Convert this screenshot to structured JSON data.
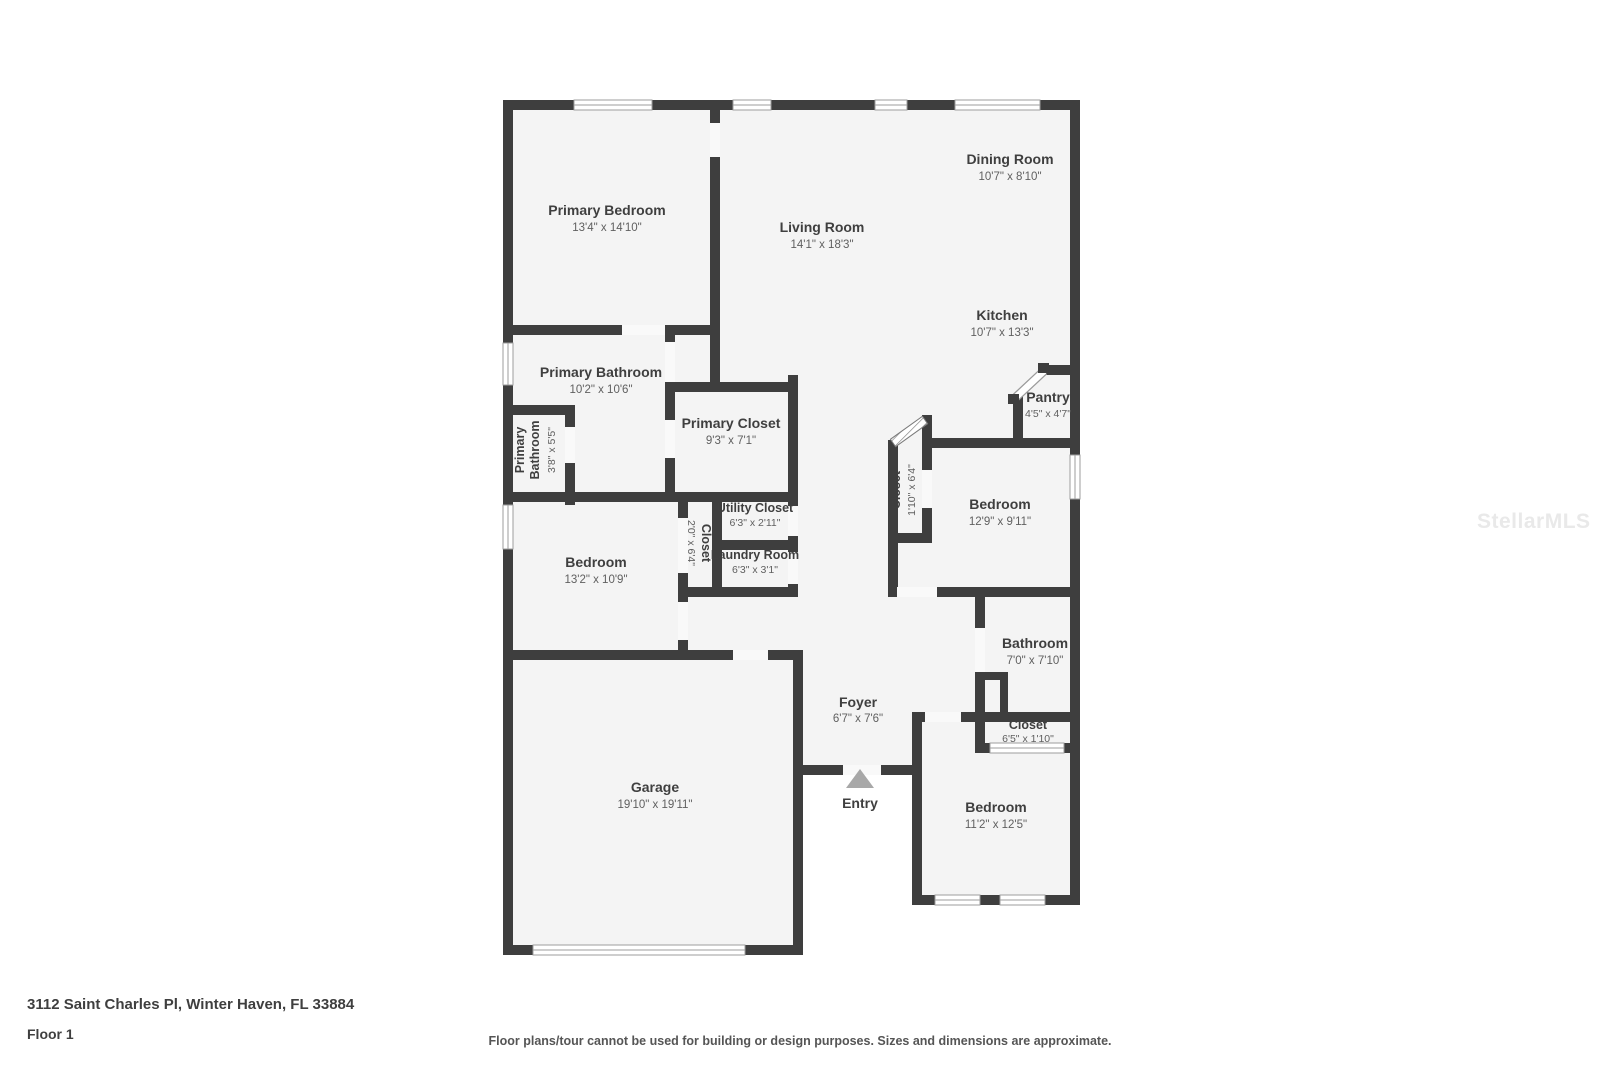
{
  "page": {
    "address": "3112 Saint Charles Pl, Winter Haven, FL 33884",
    "floor_label": "Floor 1",
    "disclaimer": "Floor plans/tour cannot be used for building or design purposes. Sizes and dimensions are approximate.",
    "watermark": "StellarMLS"
  },
  "plan": {
    "entry_label": "Entry",
    "rooms": {
      "primary_bedroom": {
        "name": "Primary Bedroom",
        "dims": "13'4\" x 14'10\""
      },
      "living_room": {
        "name": "Living Room",
        "dims": "14'1\" x 18'3\""
      },
      "dining_room": {
        "name": "Dining Room",
        "dims": "10'7\" x 8'10\""
      },
      "kitchen": {
        "name": "Kitchen",
        "dims": "10'7\" x 13'3\""
      },
      "pantry": {
        "name": "Pantry",
        "dims": "4'5\" x 4'7\""
      },
      "primary_bathroom": {
        "name": "Primary Bathroom",
        "dims": "10'2\" x 10'6\""
      },
      "primary_bathroom_small": {
        "name_line1": "Primary",
        "name_line2": "Bathroom",
        "dims": "3'8\" x 5'5\""
      },
      "primary_closet": {
        "name": "Primary Closet",
        "dims": "9'3\" x 7'1\""
      },
      "utility_closet": {
        "name": "Utility Closet",
        "dims": "6'3\" x 2'11\""
      },
      "laundry_room": {
        "name": "Laundry Room",
        "dims": "6'3\" x 3'1\""
      },
      "closet_hall": {
        "name": "Closet",
        "dims": "2'0\" x 6'4\""
      },
      "closet_kitchen": {
        "name": "Closet",
        "dims": "1'10\" x 6'4\""
      },
      "bedroom_mid": {
        "name": "Bedroom",
        "dims": "12'9\" x 9'11\""
      },
      "bedroom_left": {
        "name": "Bedroom",
        "dims": "13'2\" x 10'9\""
      },
      "bathroom": {
        "name": "Bathroom",
        "dims": "7'0\" x 7'10\""
      },
      "closet_bedroom": {
        "name": "Closet",
        "dims": "6'5\" x 1'10\""
      },
      "foyer": {
        "name": "Foyer",
        "dims": "6'7\" x 7'6\""
      },
      "garage": {
        "name": "Garage",
        "dims": "19'10\" x 19'11\""
      },
      "bedroom_br": {
        "name": "Bedroom",
        "dims": "11'2\" x 12'5\""
      }
    }
  }
}
